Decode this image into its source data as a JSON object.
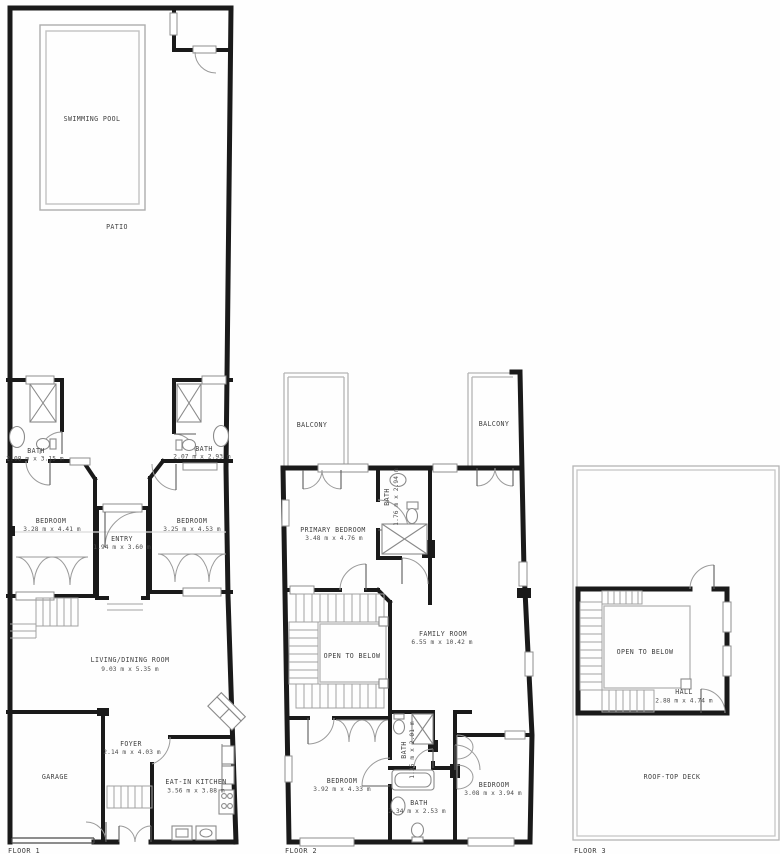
{
  "palette": {
    "wall": "#1a1a1a",
    "thin_lines": "#a8a8a8",
    "text": "#3f3f3f",
    "background": "#fefefe"
  },
  "floors": [
    {
      "label": "FLOOR 1",
      "rooms": {
        "swimming_pool": {
          "name": "SWIMMING POOL"
        },
        "patio": {
          "name": "PATIO"
        },
        "bath_left": {
          "name": "BATH",
          "dims": "2.08 m x 3.15 m"
        },
        "bath_right": {
          "name": "BATH",
          "dims": "2.07 m x 2.93 m"
        },
        "bedroom_left": {
          "name": "BEDROOM",
          "dims": "3.28 m x 4.41 m"
        },
        "bedroom_right": {
          "name": "BEDROOM",
          "dims": "3.25 m x 4.53 m"
        },
        "entry": {
          "name": "ENTRY",
          "dims": "1.94 m x 3.60 m"
        },
        "living_dining": {
          "name": "LIVING/DINING ROOM",
          "dims": "9.03 m x 5.35 m"
        },
        "foyer": {
          "name": "FOYER",
          "dims": "2.14 m x 4.03 m"
        },
        "garage": {
          "name": "GARAGE"
        },
        "kitchen": {
          "name": "EAT-IN KITCHEN",
          "dims": "3.56 m x 3.88 m"
        }
      }
    },
    {
      "label": "FLOOR 2",
      "rooms": {
        "balcony_left": {
          "name": "BALCONY"
        },
        "balcony_right": {
          "name": "BALCONY"
        },
        "primary_bedroom": {
          "name": "PRIMARY BEDROOM",
          "dims": "3.48 m x 4.76 m"
        },
        "bath_primary": {
          "name": "BATH",
          "dims": "1.76 m x 2.94 m"
        },
        "family_room": {
          "name": "FAMILY ROOM",
          "dims": "6.55 m x 10.42 m"
        },
        "open_to_below": {
          "name": "OPEN TO BELOW"
        },
        "bedroom_left": {
          "name": "BEDROOM",
          "dims": "3.92 m x 4.33 m"
        },
        "bedroom_right": {
          "name": "BEDROOM",
          "dims": "3.08 m x 3.94 m"
        },
        "bath_small": {
          "name": "BATH",
          "dims": "1.35 m x 2.01 m"
        },
        "bath_bottom": {
          "name": "BATH",
          "dims": "2.34 m x 2.53 m"
        }
      }
    },
    {
      "label": "FLOOR 3",
      "rooms": {
        "open_to_below": {
          "name": "OPEN TO BELOW"
        },
        "hall": {
          "name": "HALL",
          "dims": "2.88 m x 4.74 m"
        },
        "roof_deck": {
          "name": "ROOF-TOP DECK"
        }
      }
    }
  ]
}
